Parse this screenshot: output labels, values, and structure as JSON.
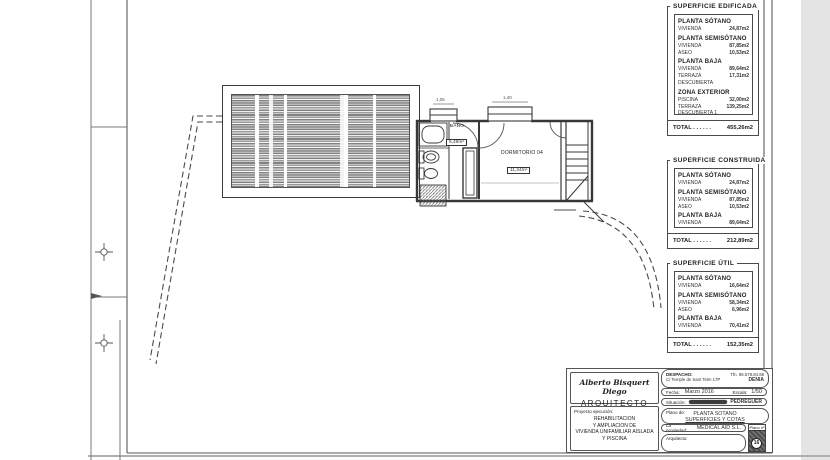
{
  "plan": {
    "bano_label": "BAÑO",
    "bano_area": "5,49m²",
    "dormitorio_label": "DORMITORIO 04",
    "dormitorio_area": "11,34m²",
    "window_dim_1": "1,05",
    "window_dim_2": "1,40"
  },
  "tables": [
    {
      "title": "SUPERFICIE EDIFICADA",
      "sections": [
        {
          "header": "PLANTA SÓTANO",
          "rows": [
            {
              "label": "VIVIENDA",
              "value": "24,87m2"
            }
          ]
        },
        {
          "header": "PLANTA SEMISÓTANO",
          "rows": [
            {
              "label": "VIVIENDA",
              "value": "87,85m2"
            },
            {
              "label": "ASEO",
              "value": "10,53m2"
            }
          ]
        },
        {
          "header": "PLANTA BAJA",
          "rows": [
            {
              "label": "VIVIENDA",
              "value": "89,64m2"
            },
            {
              "label": "TERRAZA DESCUBIERTA",
              "value": "17,31m2"
            }
          ]
        },
        {
          "header": "ZONA EXTERIOR",
          "rows": [
            {
              "label": "PISCINA",
              "value": "32,00m2"
            },
            {
              "label": "TERRAZA DESCUBIERTA 1",
              "value": "139,25m2"
            },
            {
              "label": "TERRAZA DESCUBIERTA 2",
              "value": "53,81m2"
            }
          ]
        }
      ],
      "total_label": "TOTAL . . . . . .",
      "total_value": "455,26m2"
    },
    {
      "title": "SUPERFICIE CONSTRUIDA",
      "sections": [
        {
          "header": "PLANTA SÓTANO",
          "rows": [
            {
              "label": "VIVIENDA",
              "value": "24,87m2"
            }
          ]
        },
        {
          "header": "PLANTA SEMISÓTANO",
          "rows": [
            {
              "label": "VIVIENDA",
              "value": "87,85m2"
            },
            {
              "label": "ASEO",
              "value": "10,53m2"
            }
          ]
        },
        {
          "header": "PLANTA BAJA",
          "rows": [
            {
              "label": "VIVIENDA",
              "value": "89,64m2"
            }
          ]
        }
      ],
      "total_label": "TOTAL . . . . . .",
      "total_value": "212,89m2"
    },
    {
      "title": "SUPERFICIE ÚTIL",
      "sections": [
        {
          "header": "PLANTA SÓTANO",
          "rows": [
            {
              "label": "VIVIENDA",
              "value": "16,64m2"
            }
          ]
        },
        {
          "header": "PLANTA SEMISÓTANO",
          "rows": [
            {
              "label": "VIVIENDA",
              "value": "58,34m2"
            },
            {
              "label": "ASEO",
              "value": "6,96m2"
            }
          ]
        },
        {
          "header": "PLANTA BAJA",
          "rows": [
            {
              "label": "VIVIENDA",
              "value": "70,41m2"
            }
          ]
        }
      ],
      "total_label": "TOTAL . . . . . .",
      "total_value": "152,35m2"
    }
  ],
  "titleblock": {
    "architect_name": "Alberto Bisquert Diego",
    "architect_title": "ARQUITECTO",
    "project_label": "Proyecto ejecución:",
    "project_line_1": "REHABILITACION",
    "project_line_2": "Y AMPLIACION DE",
    "project_line_3": "VIVIENDA UNIFAMILIAR AISLADA",
    "project_line_4": "Y PISCINA",
    "despacho_label": "DESPACHO:",
    "despacho_address": "C/ Temple de Sant Telm 17P",
    "phone": "Tfn. 96.578.84.88",
    "city": "DENIA",
    "fecha_label": "Fecha:",
    "fecha_value": "Marzo 2016",
    "escala_label": "Escala:",
    "escala_value": "1/50",
    "situacion_label": "Situación:",
    "situacion_city": "PEDREGUER",
    "plano_label": "Plano de:",
    "plano_line_1": "PLANTA SOTANO",
    "plano_line_2": "SUPERFICIES Y COTAS",
    "propiedad_label": "La propiedad:",
    "propiedad_value": "MEDICAL AID S.L.",
    "arquitecto_label": "Arquitecto:",
    "plano_num_label": "Plano nº",
    "plano_num": "16"
  }
}
